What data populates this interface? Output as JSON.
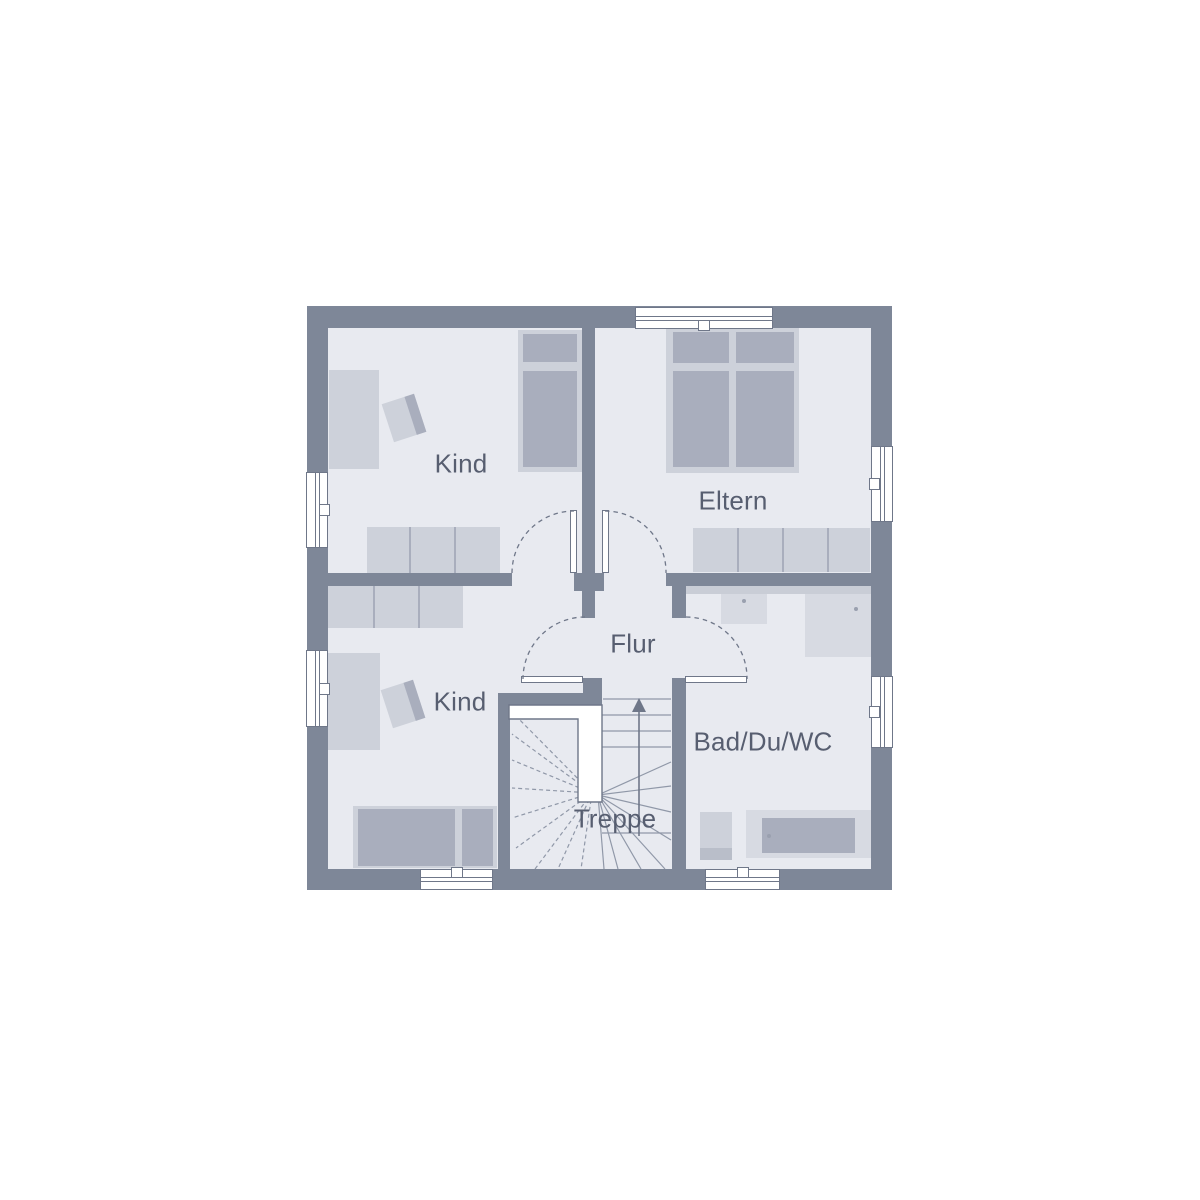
{
  "plan": {
    "rooms": [
      {
        "id": "kind-top",
        "label": "Kind"
      },
      {
        "id": "eltern",
        "label": "Eltern"
      },
      {
        "id": "kind-bottom",
        "label": "Kind"
      },
      {
        "id": "flur",
        "label": "Flur"
      },
      {
        "id": "bad",
        "label": "Bad/Du/WC"
      },
      {
        "id": "treppe",
        "label": "Treppe"
      }
    ],
    "stairs": {
      "direction_icon": "up-arrow"
    },
    "theme": {
      "background": "#ffffff",
      "wall": "#7e8798",
      "floor": "#e8eaf0",
      "furniture_light": "#cdd1da",
      "furniture_dark": "#a9aebd",
      "fixture_soft": "#d7dae2",
      "line": "#6f7789",
      "stair_line": "#9098a8",
      "label_text": "#575e70"
    }
  }
}
